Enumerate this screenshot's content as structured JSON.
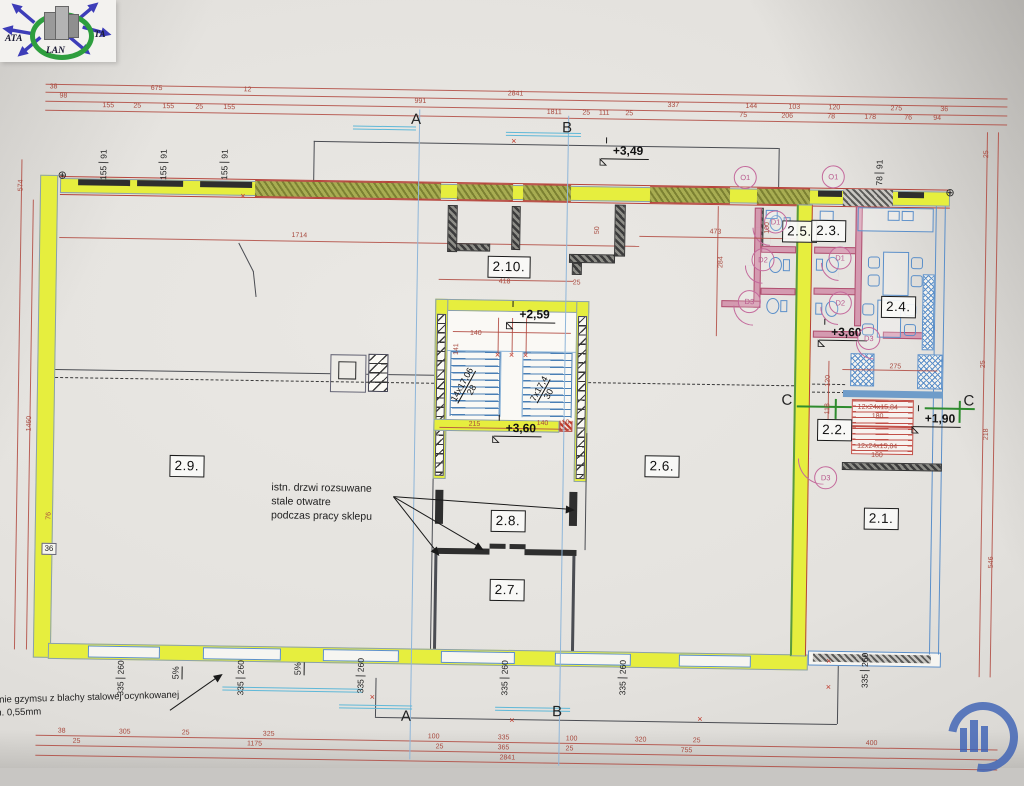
{
  "logo": {
    "ata": "ATA",
    "ta": "TA",
    "lan": "LAN"
  },
  "glyphs": {
    "x_mark": "×",
    "datum": "⊕"
  },
  "colors": {
    "highlight_yellow": "#e6ee3e",
    "dimension_red": "#a84a3f",
    "plumbing_blue": "#5b8fc9",
    "door_pink": "#c46a9c",
    "section_green": "#2e8b2e",
    "stamp_blue": "#3a5fb5"
  },
  "rooms": [
    {
      "label": "2.10.",
      "x": 510,
      "y": 260
    },
    {
      "label": "2.9.",
      "x": 191,
      "y": 464
    },
    {
      "label": "2.6.",
      "x": 666,
      "y": 457
    },
    {
      "label": "2.8.",
      "x": 513,
      "y": 514
    },
    {
      "label": "2.7.",
      "x": 513,
      "y": 583
    },
    {
      "label": "2.5.",
      "x": 800,
      "y": 220
    },
    {
      "label": "2.3.",
      "x": 829,
      "y": 219
    },
    {
      "label": "2.4.",
      "x": 900,
      "y": 294
    },
    {
      "label": "2.2.",
      "x": 838,
      "y": 418
    },
    {
      "label": "2.1.",
      "x": 886,
      "y": 506
    }
  ],
  "levels": [
    {
      "label": "+3,49",
      "x": 622,
      "y": 151
    },
    {
      "label": "+2,59",
      "x": 531,
      "y": 316
    },
    {
      "label": "+3,60",
      "x": 519,
      "y": 430
    },
    {
      "label": "+3,60",
      "x": 843,
      "y": 329
    },
    {
      "label": "+1,90",
      "x": 938,
      "y": 414
    }
  ],
  "sections": [
    {
      "label": "A",
      "x": 415,
      "y": 114
    },
    {
      "label": "B",
      "x": 566,
      "y": 120
    },
    {
      "label": "A",
      "x": 414,
      "y": 711
    },
    {
      "label": "B",
      "x": 565,
      "y": 704
    },
    {
      "label": "C",
      "x": 790,
      "y": 389
    },
    {
      "label": "C",
      "x": 972,
      "y": 387
    }
  ],
  "door_marks": [
    {
      "label": "D1",
      "x": 776,
      "y": 211
    },
    {
      "label": "D2",
      "x": 764,
      "y": 249
    },
    {
      "label": "D3",
      "x": 751,
      "y": 291
    },
    {
      "label": "D1",
      "x": 841,
      "y": 246
    },
    {
      "label": "D2",
      "x": 842,
      "y": 291
    },
    {
      "label": "D3",
      "x": 871,
      "y": 326
    },
    {
      "label": "D3",
      "x": 830,
      "y": 466
    }
  ],
  "opening_marks": [
    {
      "label": "O1",
      "x": 745,
      "y": 167
    },
    {
      "label": "O1",
      "x": 833,
      "y": 165
    }
  ],
  "window_labels": [
    {
      "a": "155",
      "b": "91",
      "x": 103,
      "y": 164
    },
    {
      "a": "155",
      "b": "91",
      "x": 163,
      "y": 163
    },
    {
      "a": "155",
      "b": "91",
      "x": 224,
      "y": 162
    },
    {
      "a": "78",
      "b": "91",
      "x": 879,
      "y": 160
    },
    {
      "a": "335",
      "b": "260",
      "x": 128,
      "y": 677
    },
    {
      "a": "335",
      "b": "260",
      "x": 248,
      "y": 675
    },
    {
      "a": "335",
      "b": "260",
      "x": 368,
      "y": 671
    },
    {
      "a": "335",
      "b": "260",
      "x": 512,
      "y": 671
    },
    {
      "a": "335",
      "b": "260",
      "x": 630,
      "y": 669
    },
    {
      "a": "335",
      "b": "260",
      "x": 872,
      "y": 658
    }
  ],
  "slope_labels": [
    {
      "label": "5%",
      "x": 184,
      "y": 671
    },
    {
      "label": "5%",
      "x": 306,
      "y": 665
    }
  ],
  "flights": [
    {
      "l1": "14x17,06",
      "l2": "28",
      "x": 470,
      "y": 381
    },
    {
      "l1": "7x17,4",
      "l2": "30",
      "x": 547,
      "y": 384
    }
  ],
  "notes": {
    "doors_l1": "istn. drzwi rozsuwane",
    "doors_l2": "stale otwatre",
    "doors_l3": "podczas pracy sklepu",
    "cornice_l1": "erznie gzymsu z blachy stalowej ocynkowanej",
    "cornice_l2": "min. 0,55mm",
    "wall_thickness": "36"
  },
  "dims": {
    "top": [
      {
        "t": "38",
        "x": 52,
        "y": 87
      },
      {
        "t": "675",
        "x": 155,
        "y": 87
      },
      {
        "t": "12",
        "x": 246,
        "y": 87
      },
      {
        "t": "2841",
        "x": 514,
        "y": 87
      },
      {
        "t": "98",
        "x": 62,
        "y": 96
      },
      {
        "t": "991",
        "x": 419,
        "y": 96
      },
      {
        "t": "337",
        "x": 672,
        "y": 96
      },
      {
        "t": "144",
        "x": 750,
        "y": 96
      },
      {
        "t": "103",
        "x": 793,
        "y": 96
      },
      {
        "t": "120",
        "x": 833,
        "y": 96
      },
      {
        "t": "275",
        "x": 895,
        "y": 96
      },
      {
        "t": "36",
        "x": 943,
        "y": 96
      },
      {
        "t": "155",
        "x": 107,
        "y": 105
      },
      {
        "t": "25",
        "x": 136,
        "y": 105
      },
      {
        "t": "155",
        "x": 167,
        "y": 105
      },
      {
        "t": "25",
        "x": 198,
        "y": 105
      },
      {
        "t": "155",
        "x": 228,
        "y": 105
      },
      {
        "t": "1811",
        "x": 553,
        "y": 105
      },
      {
        "t": "25",
        "x": 585,
        "y": 105
      },
      {
        "t": "111",
        "x": 603,
        "y": 105
      },
      {
        "t": "25",
        "x": 628,
        "y": 105
      },
      {
        "t": "75",
        "x": 742,
        "y": 105
      },
      {
        "t": "206",
        "x": 786,
        "y": 105
      },
      {
        "t": "78",
        "x": 830,
        "y": 105
      },
      {
        "t": "178",
        "x": 869,
        "y": 105
      },
      {
        "t": "76",
        "x": 907,
        "y": 105
      },
      {
        "t": "94",
        "x": 936,
        "y": 105
      }
    ],
    "bottom": [
      {
        "t": "38",
        "x": 70,
        "y": 731
      },
      {
        "t": "305",
        "x": 133,
        "y": 731
      },
      {
        "t": "25",
        "x": 194,
        "y": 731
      },
      {
        "t": "325",
        "x": 277,
        "y": 731
      },
      {
        "t": "100",
        "x": 442,
        "y": 731
      },
      {
        "t": "335",
        "x": 512,
        "y": 731
      },
      {
        "t": "100",
        "x": 580,
        "y": 731
      },
      {
        "t": "320",
        "x": 649,
        "y": 731
      },
      {
        "t": "25",
        "x": 705,
        "y": 731
      },
      {
        "t": "400",
        "x": 880,
        "y": 731
      },
      {
        "t": "25",
        "x": 85,
        "y": 741
      },
      {
        "t": "1175",
        "x": 263,
        "y": 741
      },
      {
        "t": "25",
        "x": 448,
        "y": 741
      },
      {
        "t": "365",
        "x": 512,
        "y": 741
      },
      {
        "t": "25",
        "x": 578,
        "y": 741
      },
      {
        "t": "755",
        "x": 695,
        "y": 741
      },
      {
        "t": "2841",
        "x": 516,
        "y": 751
      }
    ],
    "side": [
      {
        "t": "574",
        "x": 21,
        "y": 186
      },
      {
        "t": "1460",
        "x": 33,
        "y": 424
      },
      {
        "t": "76",
        "x": 54,
        "y": 516
      },
      {
        "t": "25",
        "x": 986,
        "y": 140
      },
      {
        "t": "25",
        "x": 986,
        "y": 350
      },
      {
        "t": "218",
        "x": 990,
        "y": 420
      },
      {
        "t": "546",
        "x": 997,
        "y": 548
      }
    ],
    "inner": [
      {
        "t": "1714",
        "x": 300,
        "y": 232
      },
      {
        "t": "418",
        "x": 506,
        "y": 275
      },
      {
        "t": "25",
        "x": 578,
        "y": 275
      },
      {
        "t": "473",
        "x": 716,
        "y": 222
      },
      {
        "t": "284",
        "x": 722,
        "y": 252,
        "rot": -90
      },
      {
        "t": "50",
        "x": 598,
        "y": 222,
        "rot": -90
      },
      {
        "t": "100",
        "x": 768,
        "y": 217,
        "rot": -90
      },
      {
        "t": "140",
        "x": 478,
        "y": 327
      },
      {
        "t": "141",
        "x": 459,
        "y": 343,
        "rot": -90
      },
      {
        "t": "215",
        "x": 478,
        "y": 418
      },
      {
        "t": "140",
        "x": 546,
        "y": 416
      },
      {
        "t": "10",
        "x": 569,
        "y": 415
      },
      {
        "t": "120",
        "x": 831,
        "y": 369,
        "rot": -90
      },
      {
        "t": "118",
        "x": 831,
        "y": 397,
        "rot": -90
      },
      {
        "t": "275",
        "x": 898,
        "y": 354
      },
      {
        "t": "12x24x15,84",
        "x": 881,
        "y": 395
      },
      {
        "t": "180",
        "x": 881,
        "y": 404
      },
      {
        "t": "12x24x15,84",
        "x": 881,
        "y": 434
      },
      {
        "t": "160",
        "x": 881,
        "y": 443
      }
    ]
  },
  "xmarks": [
    {
      "x": 513,
      "y": 134
    },
    {
      "x": 243,
      "y": 193
    },
    {
      "x": 380,
      "y": 692
    },
    {
      "x": 520,
      "y": 713
    },
    {
      "x": 708,
      "y": 709
    },
    {
      "x": 836,
      "y": 675
    },
    {
      "x": 836,
      "y": 649
    },
    {
      "x": 500,
      "y": 348
    },
    {
      "x": 514,
      "y": 348
    },
    {
      "x": 528,
      "y": 348
    }
  ],
  "datums": [
    {
      "x": 62,
      "y": 175
    },
    {
      "x": 950,
      "y": 179
    }
  ]
}
